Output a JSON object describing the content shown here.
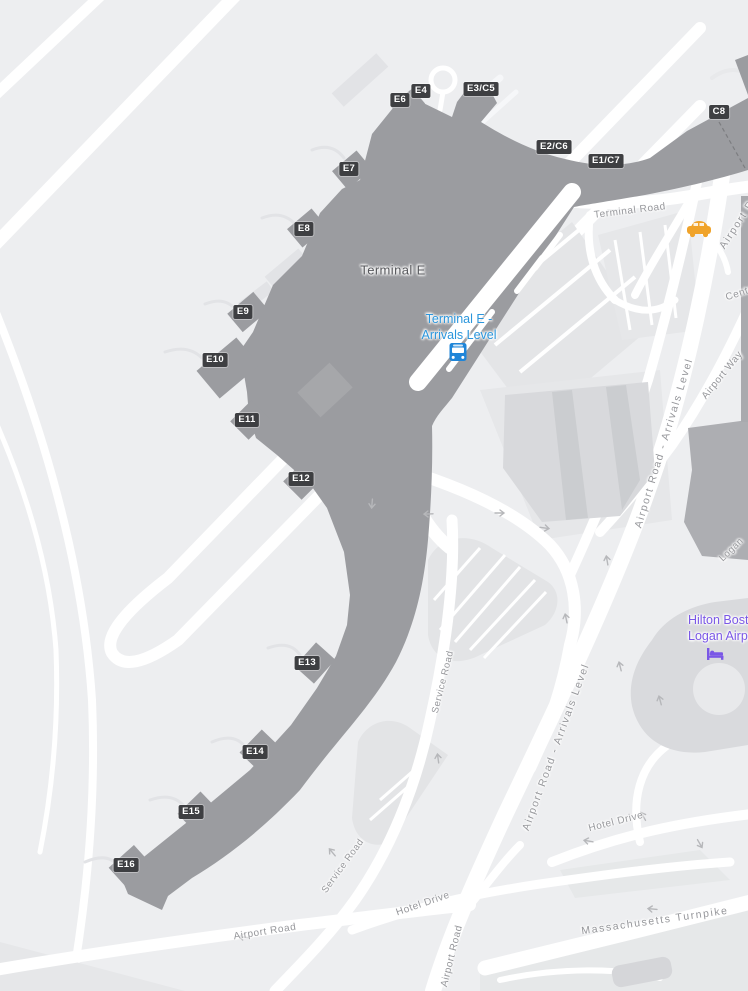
{
  "map_title": "Logan Airport Terminal E map",
  "colors": {
    "background": "#edeef0",
    "terminal_fill": "#9b9ca0",
    "road_white": "#ffffff",
    "parking_fill": "#e4e5e7",
    "building_mid": "#adaeb2",
    "building_light": "#d8d9dc",
    "gate_badge_bg": "#3e3f42",
    "gate_badge_text": "#ffffff",
    "transit_blue": "#2b96dc",
    "hotel_purple": "#7a57e6",
    "taxi_orange": "#f0a32a",
    "road_label_gray": "#96979b"
  },
  "terminal": {
    "name": "Terminal E"
  },
  "station": {
    "line1": "Terminal E -",
    "line2": "Arrivals Level",
    "icon": "bus-icon"
  },
  "hotel": {
    "line1": "Hilton Boston",
    "line2": "Logan Airport",
    "icon": "bed-icon"
  },
  "icons": {
    "taxi": "taxi-icon",
    "bus": "bus-icon",
    "bed": "bed-icon"
  },
  "gates": [
    {
      "label": "E6"
    },
    {
      "label": "E4"
    },
    {
      "label": "E3/C5"
    },
    {
      "label": "E2/C6"
    },
    {
      "label": "E1/C7"
    },
    {
      "label": "C8"
    },
    {
      "label": "E7"
    },
    {
      "label": "E8"
    },
    {
      "label": "E9"
    },
    {
      "label": "E10"
    },
    {
      "label": "E11"
    },
    {
      "label": "E12"
    },
    {
      "label": "E13"
    },
    {
      "label": "E14"
    },
    {
      "label": "E15"
    },
    {
      "label": "E16"
    }
  ],
  "roads": [
    {
      "label": "Terminal Road"
    },
    {
      "label": "Airport Road"
    },
    {
      "label": "Central"
    },
    {
      "label": "Airport Road - Arrivals Level"
    },
    {
      "label": "Airport Way"
    },
    {
      "label": "Logan"
    },
    {
      "label": "Airport Road - Arrivals Level"
    },
    {
      "label": "Service Road"
    },
    {
      "label": "Service Road"
    },
    {
      "label": "Hotel Drive"
    },
    {
      "label": "Hotel Drive"
    },
    {
      "label": "Airport Road"
    },
    {
      "label": "Massachusetts Turnpike"
    },
    {
      "label": "Airport Road"
    }
  ]
}
